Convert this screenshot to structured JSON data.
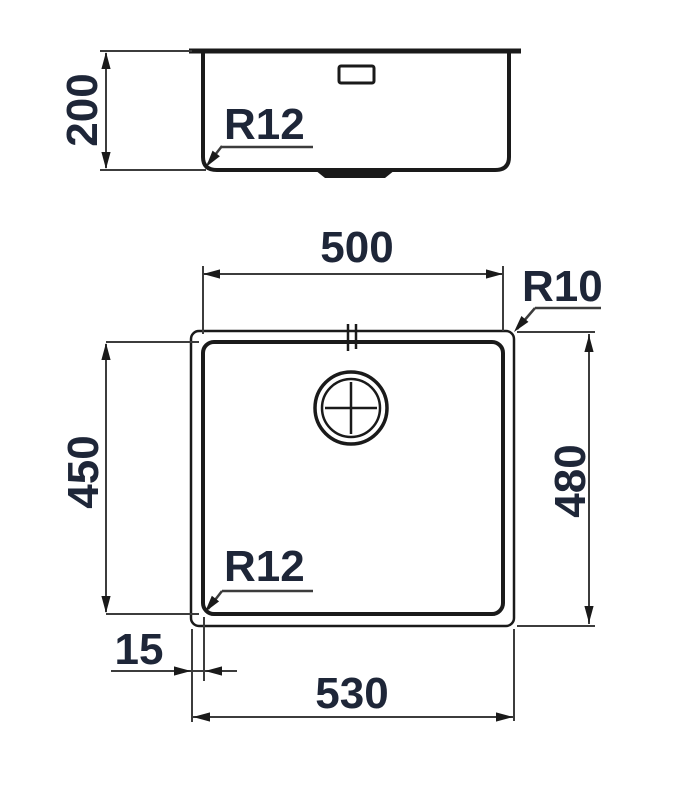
{
  "colors": {
    "line": "#1a1a1a",
    "dim_line": "#3c3c3c",
    "label": "#1e2638",
    "background": "#ffffff"
  },
  "side_view": {
    "height_label": "200",
    "bowl_radius_label": "R12"
  },
  "plan_view": {
    "inner_width_label": "500",
    "inner_height_label": "450",
    "outer_width_label": "530",
    "outer_height_label": "480",
    "rim_radius_label": "R10",
    "bowl_radius_label": "R12",
    "rim_offset_label": "15"
  }
}
